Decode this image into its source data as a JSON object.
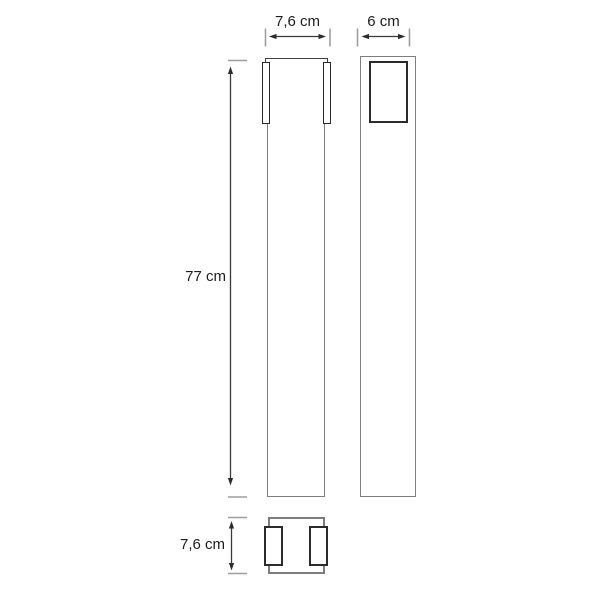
{
  "diagram": {
    "labels": {
      "front_width": "7,6 cm",
      "depth": "6 cm",
      "height": "77 cm",
      "base_width": "7,6 cm"
    },
    "colors": {
      "background": "#ffffff",
      "outline_gray": "#7d7d7d",
      "outline_dark": "#2b2b2b",
      "dimension_line": "#3a3a3a",
      "extension_tick": "#9e9e9e",
      "text": "#1c1c1c"
    }
  }
}
